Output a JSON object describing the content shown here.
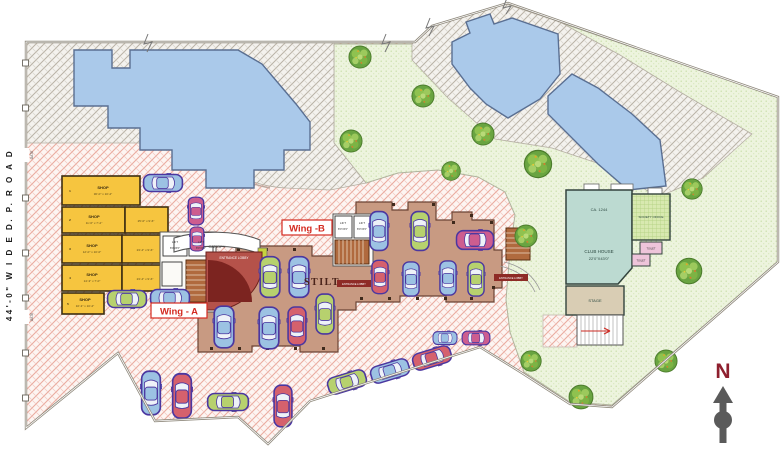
{
  "colors": {
    "carBlue": "#9cc2e3",
    "carRed": "#d5616d",
    "carGreen": "#b7d16e",
    "carMagenta": "#cd5d8f",
    "carOutline": "#4b37a0",
    "lawn": "#edf4de",
    "pavingPink": "#fdf5f2",
    "pavingGray": "#f4f2ee",
    "building": "#aac9ea",
    "shopYellow": "#f6c53f",
    "stiltTan": "#c89a82",
    "clubhouseTeal": "#bcdad1",
    "societyGreen": "#d8e9b0",
    "toiletPink": "#eec4da",
    "stageTan": "#d9cdb4",
    "entranceRed": "#b5524a",
    "stairsBrown": "#b06a3e",
    "wingLabelRed": "#d42a20",
    "northRed": "#8e1f2e"
  },
  "road": {
    "label": "44'-0\"   W I D E   D. P.  R O A D",
    "gate_top": "GATE",
    "gate_bottom": "GATE"
  },
  "labels": {
    "wing_a": "Wing - A",
    "wing_b": "Wing -B",
    "stilt": "STILT",
    "canopy": "CANOPY",
    "entrance_lobby": "ENTRANCE LOBBY",
    "lift": "LIFT",
    "lift_dims": "8'0\"x5'0\"",
    "north": "N"
  },
  "shops": [
    {
      "no": "1",
      "name": "SHOP",
      "dims": "30'-0\" x 10'-2\""
    },
    {
      "no": "2",
      "name": "SHOP",
      "dims": "11'-6\" x 7'-2\""
    },
    {
      "no": "3",
      "name": "SHOP",
      "dims": "12'-0\" x 10'-0\""
    },
    {
      "no": "4",
      "name": "SHOP",
      "dims": "14'-3\" x 7'-0\""
    },
    {
      "no": "5",
      "name": "SHOP",
      "dims": "10'-3\" x 10'-2\""
    }
  ],
  "halls": [
    {
      "dims": "25'-0\" x 9'-6\""
    },
    {
      "dims": "23'-4\" x 9'-6\""
    },
    {
      "dims": "23'-4\" x 9'-6\""
    }
  ],
  "clubhouse": {
    "area_label": "CA. 1244",
    "name": "CLUB HOUSE",
    "dims": "22'0\"X43'0\"",
    "society_office": "SOCIETY OFFICE",
    "toilet": "TOILET",
    "toilet2": "TOILET",
    "stage": "STAGE"
  },
  "cars": [
    {
      "x": 163,
      "y": 183,
      "w": 20,
      "l": 42,
      "rot": 90,
      "color": "carBlue"
    },
    {
      "x": 196,
      "y": 211,
      "w": 18,
      "l": 30,
      "rot": 0,
      "color": "carMagenta"
    },
    {
      "x": 197,
      "y": 239,
      "w": 16,
      "l": 26,
      "rot": 0,
      "color": "carMagenta"
    },
    {
      "x": 127,
      "y": 299,
      "w": 20,
      "l": 42,
      "rot": 90,
      "color": "carGreen"
    },
    {
      "x": 170,
      "y": 298,
      "w": 20,
      "l": 42,
      "rot": 90,
      "color": "carBlue"
    },
    {
      "x": 270,
      "y": 277,
      "w": 23,
      "l": 44,
      "rot": 0,
      "color": "carGreen"
    },
    {
      "x": 299,
      "y": 277,
      "w": 23,
      "l": 44,
      "rot": 0,
      "color": "carBlue"
    },
    {
      "x": 224,
      "y": 327,
      "w": 23,
      "l": 45,
      "rot": 0,
      "color": "carBlue"
    },
    {
      "x": 269,
      "y": 328,
      "w": 23,
      "l": 45,
      "rot": 0,
      "color": "carBlue"
    },
    {
      "x": 297,
      "y": 326,
      "w": 21,
      "l": 41,
      "rot": 0,
      "color": "carRed"
    },
    {
      "x": 325,
      "y": 314,
      "w": 21,
      "l": 43,
      "rot": 0,
      "color": "carGreen"
    },
    {
      "x": 445,
      "y": 338,
      "w": 15,
      "l": 26,
      "rot": 90,
      "color": "carBlue"
    },
    {
      "x": 476,
      "y": 338,
      "w": 16,
      "l": 30,
      "rot": 90,
      "color": "carMagenta"
    },
    {
      "x": 379,
      "y": 231,
      "w": 21,
      "l": 42,
      "rot": 0,
      "color": "carBlue"
    },
    {
      "x": 420,
      "y": 231,
      "w": 21,
      "l": 42,
      "rot": 0,
      "color": "carGreen"
    },
    {
      "x": 475,
      "y": 240,
      "w": 22,
      "l": 40,
      "rot": 90,
      "color": "carMagenta"
    },
    {
      "x": 380,
      "y": 277,
      "w": 19,
      "l": 36,
      "rot": 0,
      "color": "carRed"
    },
    {
      "x": 411,
      "y": 279,
      "w": 19,
      "l": 37,
      "rot": 0,
      "color": "carBlue"
    },
    {
      "x": 448,
      "y": 278,
      "w": 19,
      "l": 37,
      "rot": 0,
      "color": "carBlue"
    },
    {
      "x": 476,
      "y": 279,
      "w": 19,
      "l": 37,
      "rot": 0,
      "color": "carGreen"
    },
    {
      "x": 151,
      "y": 393,
      "w": 22,
      "l": 47,
      "rot": 0,
      "color": "carBlue"
    },
    {
      "x": 182,
      "y": 396,
      "w": 22,
      "l": 48,
      "rot": 0,
      "color": "carRed"
    },
    {
      "x": 228,
      "y": 402,
      "w": 20,
      "l": 44,
      "rot": 90,
      "color": "carGreen"
    },
    {
      "x": 283,
      "y": 406,
      "w": 21,
      "l": 45,
      "rot": 0,
      "color": "carRed"
    },
    {
      "x": 347,
      "y": 382,
      "w": 20,
      "l": 42,
      "rot": 73,
      "color": "carGreen"
    },
    {
      "x": 390,
      "y": 371,
      "w": 20,
      "l": 42,
      "rot": 73,
      "color": "carBlue"
    },
    {
      "x": 432,
      "y": 358,
      "w": 20,
      "l": 42,
      "rot": 73,
      "color": "carRed"
    }
  ],
  "trees": [
    {
      "x": 360,
      "y": 57,
      "r": 13
    },
    {
      "x": 423,
      "y": 96,
      "r": 13
    },
    {
      "x": 483,
      "y": 134,
      "r": 13
    },
    {
      "x": 351,
      "y": 141,
      "r": 13
    },
    {
      "x": 538,
      "y": 164,
      "r": 16
    },
    {
      "x": 451,
      "y": 171,
      "r": 11
    },
    {
      "x": 526,
      "y": 236,
      "r": 13
    },
    {
      "x": 692,
      "y": 189,
      "r": 12
    },
    {
      "x": 689,
      "y": 271,
      "r": 15
    },
    {
      "x": 531,
      "y": 361,
      "r": 12
    },
    {
      "x": 581,
      "y": 397,
      "r": 14
    },
    {
      "x": 666,
      "y": 361,
      "r": 13
    }
  ]
}
